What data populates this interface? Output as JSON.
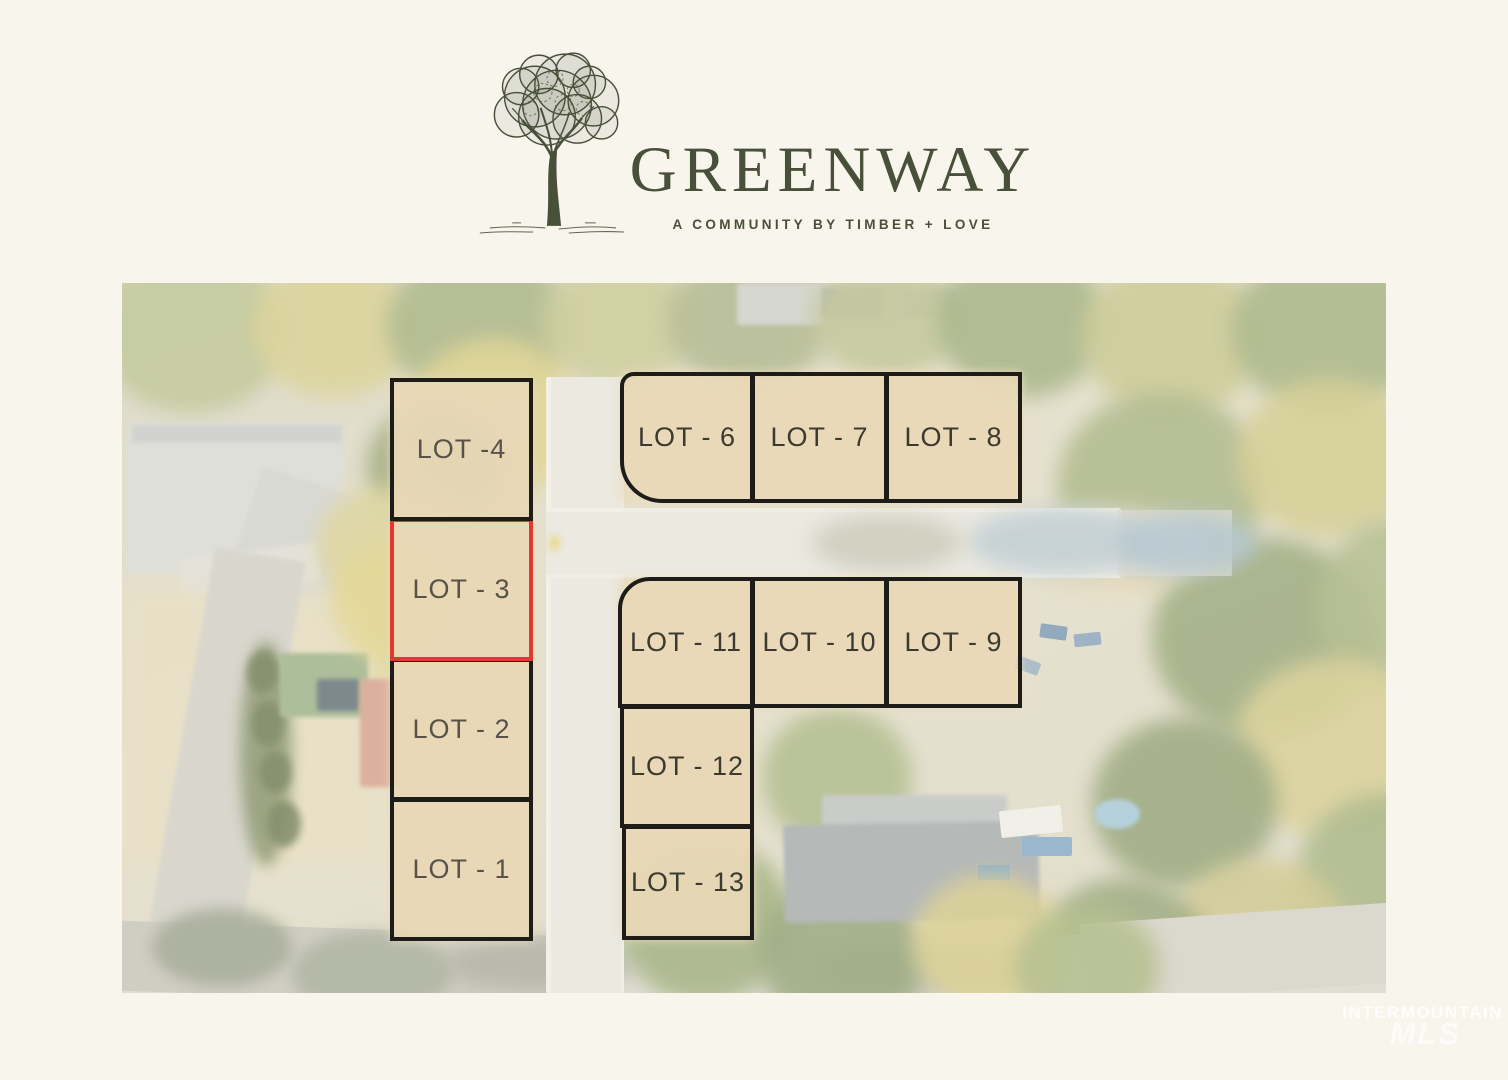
{
  "colors": {
    "background": "#f8f5ed",
    "brand": "#49503a",
    "highlight": "#e2392f",
    "outline": "#1d1c19"
  },
  "logo": {
    "title": "GREENWAY",
    "subtitle": "A COMMUNITY BY TIMBER + LOVE",
    "tree_icon": "hand-drawn-tree"
  },
  "map": {
    "description": "aerial-lot-map",
    "highlighted_lot": "LOT - 3",
    "lots": [
      {
        "id": 1,
        "label": "LOT - 1",
        "highlighted": false
      },
      {
        "id": 2,
        "label": "LOT - 2",
        "highlighted": false
      },
      {
        "id": 3,
        "label": "LOT - 3",
        "highlighted": true
      },
      {
        "id": 4,
        "label": "LOT -4",
        "highlighted": false
      },
      {
        "id": 6,
        "label": "LOT - 6",
        "highlighted": false
      },
      {
        "id": 7,
        "label": "LOT - 7",
        "highlighted": false
      },
      {
        "id": 8,
        "label": "LOT - 8",
        "highlighted": false
      },
      {
        "id": 9,
        "label": "LOT - 9",
        "highlighted": false
      },
      {
        "id": 10,
        "label": "LOT - 10",
        "highlighted": false
      },
      {
        "id": 11,
        "label": "LOT - 11",
        "highlighted": false
      },
      {
        "id": 12,
        "label": "LOT - 12",
        "highlighted": false
      },
      {
        "id": 13,
        "label": "LOT - 13",
        "highlighted": false
      }
    ],
    "watermark": {
      "line1": "INTERMOUNTAIN",
      "line2": "MLS"
    }
  }
}
